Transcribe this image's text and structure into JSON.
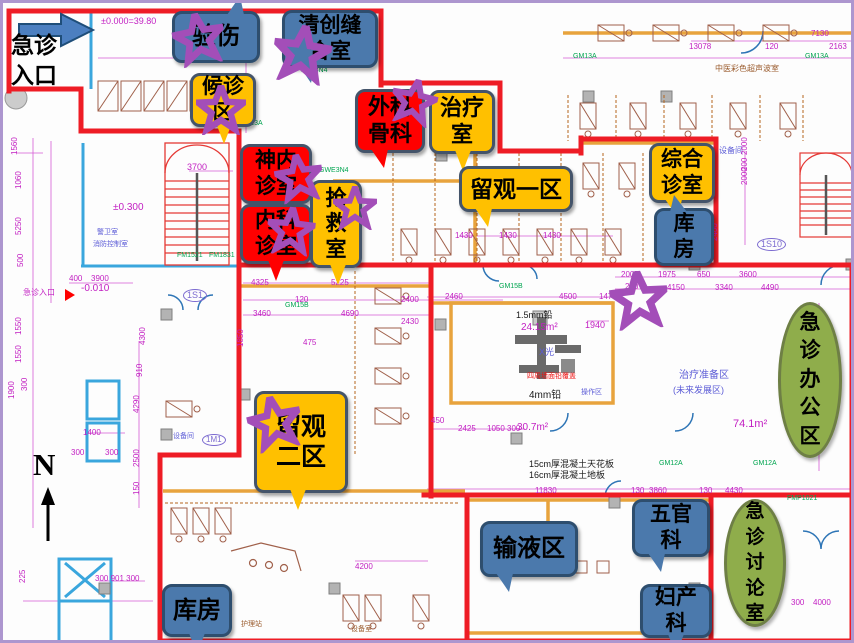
{
  "entrance": {
    "label": "急诊\n入口"
  },
  "north": {
    "label": "N"
  },
  "colors": {
    "callout_blue": "#4B79AC",
    "callout_orange": "#FFC000",
    "callout_red": "#FF0000",
    "ellipse_green": "#8FAD4B",
    "star_purple": "#A34EB8",
    "zone_red": "#EE1C25",
    "dim_magenta": "#C21FC2"
  },
  "callouts": [
    {
      "name": "injury-inspection",
      "text": "验伤",
      "style": "blue",
      "x": 169,
      "y": 8,
      "w": 88,
      "h": 52,
      "tail": "tr",
      "fs": 24
    },
    {
      "name": "debridement-suture-room",
      "text": "清创缝\n合室",
      "style": "blue",
      "x": 279,
      "y": 7,
      "w": 96,
      "h": 58,
      "tail": "bl",
      "fs": 21
    },
    {
      "name": "waiting-area",
      "text": "候诊\n区",
      "style": "orange",
      "x": 187,
      "y": 70,
      "w": 66,
      "h": 54,
      "tail": "b",
      "fs": 21
    },
    {
      "name": "surgery-orthopedics",
      "text": "外科\n骨科",
      "style": "red",
      "x": 352,
      "y": 86,
      "w": 70,
      "h": 64,
      "tail": "bl",
      "fs": 22
    },
    {
      "name": "treatment-room",
      "text": "治疗\n室",
      "style": "orange",
      "x": 426,
      "y": 87,
      "w": 66,
      "h": 64,
      "tail": "b",
      "fs": 22
    },
    {
      "name": "neurology-clinic",
      "text": "神内\n诊室",
      "style": "red",
      "x": 237,
      "y": 141,
      "w": 72,
      "h": 60,
      "tail": "none",
      "fs": 21
    },
    {
      "name": "internal-medicine-clinic",
      "text": "内科\n诊室",
      "style": "red",
      "x": 237,
      "y": 201,
      "w": 72,
      "h": 60,
      "tail": "b",
      "fs": 21
    },
    {
      "name": "rescue-room",
      "text": "抢\n救\n室",
      "style": "orange",
      "x": 307,
      "y": 177,
      "w": 52,
      "h": 88,
      "tail": "b",
      "fs": 21
    },
    {
      "name": "observation-area-1",
      "text": "留观一区",
      "style": "orange",
      "x": 456,
      "y": 163,
      "w": 114,
      "h": 46,
      "tail": "bl",
      "fs": 23
    },
    {
      "name": "general-clinic",
      "text": "综合\n诊室",
      "style": "orange",
      "x": 646,
      "y": 140,
      "w": 66,
      "h": 60,
      "tail": "bl",
      "fs": 21
    },
    {
      "name": "storage-room-1",
      "text": "库\n房",
      "style": "blue",
      "x": 651,
      "y": 205,
      "w": 60,
      "h": 58,
      "tail": "tl",
      "fs": 21
    },
    {
      "name": "observation-area-2",
      "text": "留观\n二区",
      "style": "orange",
      "x": 251,
      "y": 388,
      "w": 94,
      "h": 102,
      "tail": "b",
      "fs": 25
    },
    {
      "name": "infusion-area",
      "text": "输液区",
      "style": "blue",
      "x": 477,
      "y": 518,
      "w": 98,
      "h": 56,
      "tail": "bl",
      "fs": 24
    },
    {
      "name": "ent-department",
      "text": "五官\n科",
      "style": "blue",
      "x": 629,
      "y": 496,
      "w": 78,
      "h": 58,
      "tail": "bl",
      "fs": 21
    },
    {
      "name": "obstetrics-gynecology",
      "text": "妇产\n科",
      "style": "blue",
      "x": 637,
      "y": 581,
      "w": 72,
      "h": 54,
      "tail": "b",
      "fs": 21
    },
    {
      "name": "storage-room-2",
      "text": "库房",
      "style": "blue",
      "x": 159,
      "y": 581,
      "w": 70,
      "h": 53,
      "tail": "b",
      "fs": 24
    }
  ],
  "ellipses": [
    {
      "name": "emergency-office-area",
      "text": "急\n诊\n办\n公\n区",
      "x": 775,
      "y": 299,
      "w": 64,
      "h": 156,
      "fs": 21
    },
    {
      "name": "emergency-discussion-room",
      "text": "急\n诊\n讨\n论\n室",
      "x": 721,
      "y": 496,
      "w": 62,
      "h": 128,
      "fs": 19
    }
  ],
  "stars": [
    {
      "x": 196,
      "y": 36,
      "s": 52,
      "r": -10
    },
    {
      "x": 299,
      "y": 51,
      "s": 58,
      "r": 8
    },
    {
      "x": 218,
      "y": 107,
      "s": 50,
      "r": 0
    },
    {
      "x": 411,
      "y": 99,
      "s": 46,
      "r": 12
    },
    {
      "x": 296,
      "y": 175,
      "s": 48,
      "r": -8
    },
    {
      "x": 288,
      "y": 228,
      "s": 48,
      "r": 5
    },
    {
      "x": 352,
      "y": 205,
      "s": 44,
      "r": 0
    },
    {
      "x": 272,
      "y": 420,
      "s": 54,
      "r": -12
    },
    {
      "x": 636,
      "y": 297,
      "s": 58,
      "r": -5
    }
  ],
  "cad_texts": [
    {
      "t": "±0.000=39.80",
      "x": 98,
      "y": 14,
      "c": "m",
      "s": 9
    },
    {
      "t": "±0.300",
      "x": 110,
      "y": 200,
      "c": "m",
      "s": 10
    },
    {
      "t": "-0.010",
      "x": 78,
      "y": 281,
      "c": "m",
      "s": 10
    },
    {
      "t": "3700",
      "x": 184,
      "y": 160,
      "c": "m",
      "s": 9
    },
    {
      "t": "3900",
      "x": 88,
      "y": 272,
      "c": "m",
      "s": 8
    },
    {
      "t": "400",
      "x": 66,
      "y": 272,
      "c": "m",
      "s": 8
    },
    {
      "t": "1S1",
      "x": 180,
      "y": 286,
      "c": "p",
      "s": 9,
      "cir": 1
    },
    {
      "t": "1M1",
      "x": 199,
      "y": 431,
      "c": "p",
      "s": 8,
      "cir": 1
    },
    {
      "t": "1S10",
      "x": 754,
      "y": 235,
      "c": "p",
      "s": 9,
      "cir": 1
    },
    {
      "t": "74.1m²",
      "x": 730,
      "y": 416,
      "c": "m",
      "s": 11
    },
    {
      "t": "24.15m²",
      "x": 518,
      "y": 320,
      "c": "m",
      "s": 10
    },
    {
      "t": "30.7m²",
      "x": 514,
      "y": 420,
      "c": "m",
      "s": 10
    },
    {
      "t": "1.5mm铅",
      "x": 513,
      "y": 308,
      "c": "k",
      "s": 9
    },
    {
      "t": "4mm铅",
      "x": 526,
      "y": 388,
      "c": "k",
      "s": 10
    },
    {
      "t": "X光",
      "x": 536,
      "y": 345,
      "c": "b",
      "s": 9
    },
    {
      "t": "四周墙面铅覆盖",
      "x": 524,
      "y": 370,
      "c": "r",
      "s": 7
    },
    {
      "t": "15cm厚混凝土天花板",
      "x": 526,
      "y": 457,
      "c": "k",
      "s": 9
    },
    {
      "t": "16cm厚混凝土地板",
      "x": 526,
      "y": 468,
      "c": "k",
      "s": 9
    },
    {
      "t": "治疗准备区",
      "x": 676,
      "y": 368,
      "c": "b",
      "s": 10
    },
    {
      "t": "(未来发展区)",
      "x": 670,
      "y": 383,
      "c": "b",
      "s": 9
    },
    {
      "t": "中医彩色超声波室",
      "x": 712,
      "y": 62,
      "c": "n",
      "s": 8
    },
    {
      "t": "警卫室",
      "x": 94,
      "y": 226,
      "c": "b",
      "s": 7
    },
    {
      "t": "消防控制室",
      "x": 90,
      "y": 238,
      "c": "b",
      "s": 7
    },
    {
      "t": "急诊入口",
      "x": 20,
      "y": 286,
      "c": "m",
      "s": 8
    },
    {
      "t": "设备间",
      "x": 716,
      "y": 144,
      "c": "b",
      "s": 8
    },
    {
      "t": "设备间",
      "x": 170,
      "y": 430,
      "c": "b",
      "s": 7
    },
    {
      "t": "护理站",
      "x": 238,
      "y": 618,
      "c": "n",
      "s": 7
    },
    {
      "t": "操作区",
      "x": 578,
      "y": 386,
      "c": "b",
      "s": 7
    },
    {
      "t": "1940",
      "x": 582,
      "y": 318,
      "c": "m",
      "s": 9
    },
    {
      "t": "设备室",
      "x": 348,
      "y": 623,
      "c": "n",
      "s": 7
    },
    {
      "t": "13078",
      "x": 686,
      "y": 40
    },
    {
      "t": "7130",
      "x": 808,
      "y": 27
    },
    {
      "t": "2163",
      "x": 826,
      "y": 40
    },
    {
      "t": "120",
      "x": 762,
      "y": 40
    },
    {
      "t": "1560",
      "x": 8,
      "y": 152,
      "rot": -90
    },
    {
      "t": "1060",
      "x": 12,
      "y": 186,
      "rot": -90
    },
    {
      "t": "5250",
      "x": 12,
      "y": 232,
      "rot": -90
    },
    {
      "t": "500",
      "x": 14,
      "y": 264,
      "rot": -90
    },
    {
      "t": "1550",
      "x": 12,
      "y": 332,
      "rot": -90
    },
    {
      "t": "1550",
      "x": 12,
      "y": 360,
      "rot": -90
    },
    {
      "t": "1900",
      "x": 5,
      "y": 396,
      "rot": -90
    },
    {
      "t": "300",
      "x": 18,
      "y": 388,
      "rot": -90
    },
    {
      "t": "4300",
      "x": 136,
      "y": 342,
      "rot": -90
    },
    {
      "t": "910",
      "x": 133,
      "y": 374,
      "rot": -90
    },
    {
      "t": "4290",
      "x": 130,
      "y": 410,
      "rot": -90
    },
    {
      "t": "2500",
      "x": 130,
      "y": 464,
      "rot": -90
    },
    {
      "t": "150",
      "x": 130,
      "y": 492,
      "rot": -90
    },
    {
      "t": "1400",
      "x": 80,
      "y": 426
    },
    {
      "t": "300",
      "x": 68,
      "y": 446
    },
    {
      "t": "300",
      "x": 102,
      "y": 446
    },
    {
      "t": "225",
      "x": 16,
      "y": 580,
      "rot": -90
    },
    {
      "t": "4325",
      "x": 248,
      "y": 276
    },
    {
      "t": "5225",
      "x": 328,
      "y": 276
    },
    {
      "t": "120",
      "x": 292,
      "y": 293
    },
    {
      "t": "3460",
      "x": 250,
      "y": 307
    },
    {
      "t": "4690",
      "x": 338,
      "y": 307
    },
    {
      "t": "475",
      "x": 300,
      "y": 336
    },
    {
      "t": "1850",
      "x": 234,
      "y": 344,
      "rot": -90
    },
    {
      "t": "2400",
      "x": 398,
      "y": 293
    },
    {
      "t": "2430",
      "x": 398,
      "y": 315
    },
    {
      "t": "1430",
      "x": 452,
      "y": 229
    },
    {
      "t": "1430",
      "x": 496,
      "y": 229
    },
    {
      "t": "1430",
      "x": 540,
      "y": 229
    },
    {
      "t": "2460",
      "x": 442,
      "y": 290
    },
    {
      "t": "4500",
      "x": 556,
      "y": 290
    },
    {
      "t": "1470",
      "x": 596,
      "y": 290
    },
    {
      "t": "2425",
      "x": 455,
      "y": 422
    },
    {
      "t": "1050",
      "x": 484,
      "y": 422
    },
    {
      "t": "300",
      "x": 504,
      "y": 422
    },
    {
      "t": "450",
      "x": 428,
      "y": 414
    },
    {
      "t": "2005",
      "x": 618,
      "y": 268
    },
    {
      "t": "1975",
      "x": 655,
      "y": 268
    },
    {
      "t": "650",
      "x": 694,
      "y": 268
    },
    {
      "t": "3600",
      "x": 736,
      "y": 268
    },
    {
      "t": "240",
      "x": 622,
      "y": 280
    },
    {
      "t": "4150",
      "x": 664,
      "y": 281
    },
    {
      "t": "3340",
      "x": 712,
      "y": 281
    },
    {
      "t": "4490",
      "x": 758,
      "y": 281
    },
    {
      "t": "2000",
      "x": 738,
      "y": 152,
      "rot": -90
    },
    {
      "t": "200",
      "x": 738,
      "y": 168,
      "rot": -90
    },
    {
      "t": "2000",
      "x": 738,
      "y": 182,
      "rot": -90
    },
    {
      "t": "2400",
      "x": 708,
      "y": 238,
      "rot": -90
    },
    {
      "t": "11830",
      "x": 532,
      "y": 484
    },
    {
      "t": "130",
      "x": 628,
      "y": 484
    },
    {
      "t": "3860",
      "x": 646,
      "y": 484
    },
    {
      "t": "130",
      "x": 696,
      "y": 484
    },
    {
      "t": "4430",
      "x": 722,
      "y": 484
    },
    {
      "t": "300",
      "x": 788,
      "y": 596
    },
    {
      "t": "4000",
      "x": 810,
      "y": 596
    },
    {
      "t": "300 901 300",
      "x": 92,
      "y": 572
    },
    {
      "t": "4200",
      "x": 352,
      "y": 560
    },
    {
      "t": "GM13A",
      "x": 236,
      "y": 117,
      "c": "g",
      "s": 7
    },
    {
      "t": "NE13N4",
      "x": 298,
      "y": 64,
      "c": "g",
      "s": 7
    },
    {
      "t": "GWE3N4",
      "x": 316,
      "y": 164,
      "c": "g",
      "s": 7
    },
    {
      "t": "GM15B",
      "x": 282,
      "y": 299,
      "c": "g",
      "s": 7
    },
    {
      "t": "GM15B",
      "x": 496,
      "y": 280,
      "c": "g",
      "s": 7
    },
    {
      "t": "GM12A",
      "x": 656,
      "y": 457,
      "c": "g",
      "s": 7
    },
    {
      "t": "GM12A",
      "x": 750,
      "y": 457,
      "c": "g",
      "s": 7
    },
    {
      "t": "GM13A",
      "x": 570,
      "y": 50,
      "c": "g",
      "s": 7
    },
    {
      "t": "GM13A",
      "x": 802,
      "y": 50,
      "c": "g",
      "s": 7
    },
    {
      "t": "FM1521",
      "x": 174,
      "y": 249,
      "c": "g",
      "s": 7
    },
    {
      "t": "FM1831",
      "x": 206,
      "y": 249,
      "c": "g",
      "s": 7
    },
    {
      "t": "FMP1021",
      "x": 784,
      "y": 492,
      "c": "g",
      "s": 7
    }
  ]
}
